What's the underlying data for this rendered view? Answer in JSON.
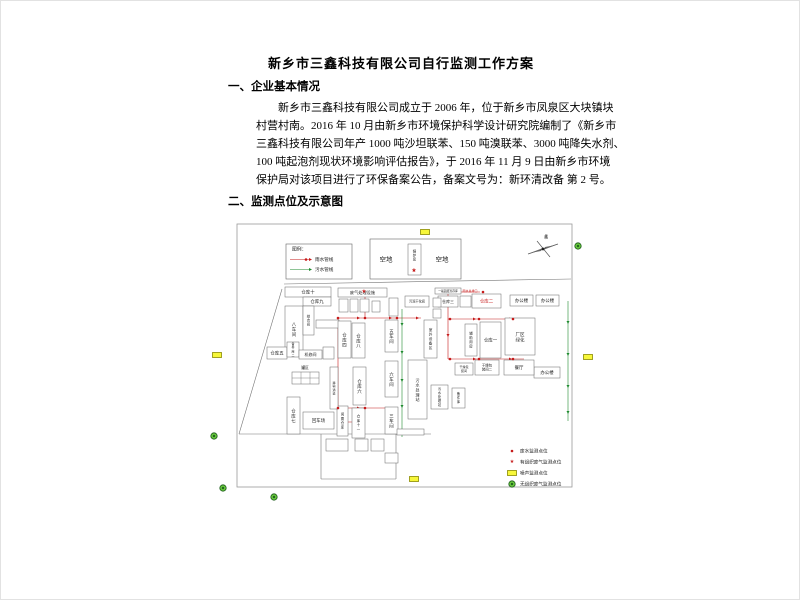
{
  "page": {
    "title": "新乡市三鑫科技有限公司自行监测工作方案",
    "section1": "一、企业基本情况",
    "paragraph_lines": [
      "新乡市三鑫科技有限公司成立于 2006 年，位于新乡市凤泉区大块镇块",
      "村营村南。2016 年 10 月由新乡市环境保护科学设计研究院编制了《新乡市",
      "三鑫科技有限公司年产 1000 吨沙坦联苯、150 吨溴联苯、3000 吨降失水剂、",
      "100 吨起泡剂现状环境影响评估报告》，于 2016 年 11 月 9 日由新乡市环境",
      "保护局对该项目进行了环保备案公告，备案文号为：新环清改备 第 2 号。"
    ],
    "section2": "二、监测点位及示意图"
  },
  "colors": {
    "red": "#c61a1a",
    "green": "#1f8a2f",
    "noise_fill": "#f7f73a",
    "noise_stroke": "#8a8a00",
    "gas_fill": "#63c23a",
    "gas_stroke": "#1d5c1d",
    "line_gray": "#777777",
    "box_stroke": "#666666",
    "label": "#222222"
  },
  "diagram": {
    "border": {
      "x": 236,
      "y": 223,
      "w": 335,
      "h": 263
    },
    "pipe_legend": {
      "x": 285,
      "y": 243,
      "w": 66,
      "h": 35,
      "title": "图例：",
      "items": [
        {
          "label": "雨水管线",
          "color_key": "red"
        },
        {
          "label": "污水管线",
          "color_key": "green"
        }
      ]
    },
    "empty_lot": {
      "box": {
        "x": 369,
        "y": 238,
        "w": 91,
        "h": 40
      },
      "labels": [
        {
          "t": "空地",
          "x": 385,
          "y": 259
        },
        {
          "t": "空地",
          "x": 441,
          "y": 259
        }
      ],
      "boiler": {
        "label": "锅炉房",
        "x": 407,
        "y": 243,
        "w": 13,
        "h": 31
      },
      "star": {
        "x": 413,
        "y": 270
      }
    },
    "compass": {
      "cx": 542,
      "cy": 248,
      "label": "北"
    },
    "boundary_lines": [
      [
        281,
        288,
        238,
        433
      ],
      [
        238,
        433,
        320,
        433
      ],
      [
        320,
        433,
        320,
        478
      ],
      [
        320,
        478,
        395,
        478
      ],
      [
        395,
        478,
        395,
        433
      ],
      [
        320,
        433,
        430,
        433
      ],
      [
        283,
        283,
        570,
        278
      ]
    ],
    "buildings": [
      {
        "l": "仓库十",
        "x": 284,
        "y": 286,
        "w": 46,
        "h": 10
      },
      {
        "l": "仓库九",
        "x": 302,
        "y": 296,
        "w": 28,
        "h": 9
      },
      {
        "l": "八车间",
        "x": 284,
        "y": 305,
        "w": 18,
        "h": 46,
        "v": 1
      },
      {
        "l": "综合间",
        "x": 302,
        "y": 305,
        "w": 11,
        "h": 29,
        "v": 1,
        "fs": 3.4
      },
      {
        "l": "",
        "x": 315,
        "y": 319,
        "w": 23,
        "h": 8
      },
      {
        "l": "仓库五",
        "x": 266,
        "y": 346,
        "w": 20,
        "h": 12
      },
      {
        "l": "备件库二",
        "x": 286,
        "y": 341,
        "w": 12,
        "h": 15,
        "v": 1,
        "fs": 3
      },
      {
        "l": "机修间",
        "x": 298,
        "y": 349,
        "w": 23,
        "h": 9,
        "fs": 4
      },
      {
        "l": "",
        "x": 322,
        "y": 346,
        "w": 11,
        "h": 12
      },
      {
        "l": "仓库七",
        "x": 286,
        "y": 396,
        "w": 13,
        "h": 37,
        "v": 1
      },
      {
        "l": "回车场",
        "x": 302,
        "y": 411,
        "w": 31,
        "h": 17
      },
      {
        "l": "闲置仓库",
        "x": 336,
        "y": 405,
        "w": 11,
        "h": 30,
        "v": 1,
        "fs": 3.4
      },
      {
        "l": "仓库十一",
        "x": 351,
        "y": 407,
        "w": 13,
        "h": 30,
        "v": 1,
        "fs": 3.4
      },
      {
        "l": "运输通道",
        "x": 329,
        "y": 366,
        "w": 8,
        "h": 42,
        "v": 1,
        "fs": 3
      },
      {
        "l": "仓库六",
        "x": 352,
        "y": 366,
        "w": 13,
        "h": 38,
        "v": 1
      },
      {
        "l": "仓库四",
        "x": 337,
        "y": 320,
        "w": 13,
        "h": 37,
        "v": 1
      },
      {
        "l": "仓库八",
        "x": 351,
        "y": 322,
        "w": 13,
        "h": 35,
        "v": 1
      },
      {
        "l": "五车间",
        "x": 384,
        "y": 319,
        "w": 13,
        "h": 32,
        "v": 1
      },
      {
        "l": "六车间",
        "x": 384,
        "y": 360,
        "w": 13,
        "h": 36,
        "v": 1
      },
      {
        "l": "三车间",
        "x": 384,
        "y": 406,
        "w": 13,
        "h": 27,
        "v": 1
      },
      {
        "l": "污水处理站",
        "x": 407,
        "y": 359,
        "w": 19,
        "h": 59,
        "v": 1,
        "fs": 4
      },
      {
        "l": "污水处理站",
        "x": 430,
        "y": 384,
        "w": 17,
        "h": 24,
        "v": 1,
        "fs": 3.2
      },
      {
        "l": "备件库",
        "x": 451,
        "y": 387,
        "w": 13,
        "h": 20,
        "v": 1,
        "fs": 3.2
      },
      {
        "l": "室外设备区",
        "x": 423,
        "y": 319,
        "w": 13,
        "h": 38,
        "v": 1,
        "fs": 3.6
      },
      {
        "l": "辅助用房",
        "x": 464,
        "y": 323,
        "w": 12,
        "h": 32,
        "v": 1,
        "fs": 3.4
      },
      {
        "l": "仓库一",
        "x": 479,
        "y": 321,
        "w": 21,
        "h": 36
      },
      {
        "l": "厂区绿化",
        "x": 504,
        "y": 317,
        "w": 30,
        "h": 37,
        "two": 1,
        "fs": 4.5
      },
      {
        "l": "仓库三",
        "x": 437,
        "y": 295,
        "w": 20,
        "h": 11,
        "fs": 4
      },
      {
        "l": "",
        "x": 459,
        "y": 295,
        "w": 11,
        "h": 11
      },
      {
        "l": "仓库二",
        "x": 471,
        "y": 293,
        "w": 29,
        "h": 14,
        "red": 1
      },
      {
        "l": "办公楼",
        "x": 509,
        "y": 294,
        "w": 23,
        "h": 11
      },
      {
        "l": "办公楼",
        "x": 535,
        "y": 294,
        "w": 23,
        "h": 11
      },
      {
        "l": "办公楼",
        "x": 533,
        "y": 366,
        "w": 26,
        "h": 11
      },
      {
        "l": "餐厅",
        "x": 503,
        "y": 359,
        "w": 30,
        "h": 15
      },
      {
        "l": "干燥包装间二",
        "x": 474,
        "y": 359,
        "w": 24,
        "h": 15,
        "two": 1,
        "fs": 3.4
      },
      {
        "l": "干燥包装间",
        "x": 454,
        "y": 362,
        "w": 18,
        "h": 12,
        "two": 1,
        "fs": 3
      },
      {
        "l": "废气处理设施",
        "x": 337,
        "y": 287,
        "w": 49,
        "h": 9,
        "fs": 4.2
      },
      {
        "l": "",
        "x": 338,
        "y": 298,
        "w": 9,
        "h": 13
      },
      {
        "l": "",
        "x": 349,
        "y": 298,
        "w": 8,
        "h": 13
      },
      {
        "l": "",
        "x": 359,
        "y": 298,
        "w": 9,
        "h": 13
      },
      {
        "l": "",
        "x": 371,
        "y": 300,
        "w": 8,
        "h": 11
      },
      {
        "l": "",
        "x": 388,
        "y": 297,
        "w": 9,
        "h": 18
      },
      {
        "l": "污泥干化间",
        "x": 404,
        "y": 295,
        "w": 24,
        "h": 11,
        "fs": 3.2
      },
      {
        "l": "",
        "x": 432,
        "y": 297,
        "w": 8,
        "h": 9
      },
      {
        "l": "",
        "x": 432,
        "y": 308,
        "w": 8,
        "h": 9
      },
      {
        "l": "一般固废暂存库",
        "x": 434,
        "y": 287,
        "w": 26,
        "h": 6,
        "fs": 2.8
      },
      {
        "l": "",
        "x": 325,
        "y": 438,
        "w": 22,
        "h": 12
      },
      {
        "l": "",
        "x": 354,
        "y": 438,
        "w": 13,
        "h": 12
      },
      {
        "l": "",
        "x": 370,
        "y": 438,
        "w": 13,
        "h": 12
      },
      {
        "l": "",
        "x": 384,
        "y": 452,
        "w": 13,
        "h": 10
      },
      {
        "l": "",
        "x": 396,
        "y": 428,
        "w": 27,
        "h": 6
      }
    ],
    "tank": {
      "x": 291,
      "y": 371,
      "w": 27,
      "h": 12,
      "cols": 3,
      "rows": 2,
      "label": "罐区",
      "lx": 304,
      "ly": 367
    },
    "free_labels": [
      {
        "t": "雨水总排口",
        "x": 469,
        "y": 290,
        "fs": 3,
        "red": 1
      },
      {
        "t": "北",
        "x": 545,
        "y": 236,
        "fs": 4
      }
    ],
    "pipelines": [
      {
        "x1": 337,
        "y1": 317,
        "x2": 420,
        "y2": 317,
        "c": "red"
      },
      {
        "x1": 364,
        "y1": 296,
        "x2": 364,
        "y2": 317,
        "c": "red"
      },
      {
        "x1": 447,
        "y1": 291,
        "x2": 479,
        "y2": 291,
        "c": "red"
      },
      {
        "x1": 447,
        "y1": 291,
        "x2": 447,
        "y2": 358,
        "c": "red"
      },
      {
        "x1": 447,
        "y1": 318,
        "x2": 523,
        "y2": 318,
        "c": "red"
      },
      {
        "x1": 447,
        "y1": 358,
        "x2": 523,
        "y2": 358,
        "c": "red"
      },
      {
        "x1": 337,
        "y1": 317,
        "x2": 337,
        "y2": 421,
        "c": "red"
      },
      {
        "x1": 337,
        "y1": 407,
        "x2": 395,
        "y2": 407,
        "c": "red"
      },
      {
        "x1": 337,
        "y1": 421,
        "x2": 364,
        "y2": 421,
        "c": "red"
      },
      {
        "x1": 401,
        "y1": 308,
        "x2": 401,
        "y2": 436,
        "c": "green"
      },
      {
        "x1": 567,
        "y1": 300,
        "x2": 567,
        "y2": 420,
        "c": "green"
      }
    ],
    "arrows": [
      {
        "x": 356,
        "y": 317,
        "d": "r",
        "c": "red"
      },
      {
        "x": 388,
        "y": 317,
        "d": "r",
        "c": "red"
      },
      {
        "x": 415,
        "y": 317,
        "d": "r",
        "c": "red"
      },
      {
        "x": 472,
        "y": 318,
        "d": "r",
        "c": "red"
      },
      {
        "x": 508,
        "y": 318,
        "d": "r",
        "c": "red"
      },
      {
        "x": 472,
        "y": 358,
        "d": "r",
        "c": "red"
      },
      {
        "x": 508,
        "y": 358,
        "d": "r",
        "c": "red"
      },
      {
        "x": 356,
        "y": 407,
        "d": "r",
        "c": "red"
      },
      {
        "x": 364,
        "y": 306,
        "d": "d",
        "c": "red"
      },
      {
        "x": 447,
        "y": 333,
        "d": "d",
        "c": "red"
      },
      {
        "x": 401,
        "y": 322,
        "d": "d",
        "c": "green"
      },
      {
        "x": 401,
        "y": 350,
        "d": "d",
        "c": "green"
      },
      {
        "x": 401,
        "y": 378,
        "d": "d",
        "c": "green"
      },
      {
        "x": 401,
        "y": 404,
        "d": "d",
        "c": "green"
      },
      {
        "x": 401,
        "y": 428,
        "d": "d",
        "c": "green"
      },
      {
        "x": 567,
        "y": 320,
        "d": "d",
        "c": "green"
      },
      {
        "x": 567,
        "y": 352,
        "d": "d",
        "c": "green"
      },
      {
        "x": 567,
        "y": 384,
        "d": "d",
        "c": "green"
      },
      {
        "x": 567,
        "y": 410,
        "d": "d",
        "c": "green"
      }
    ],
    "dots": [
      [
        482,
        291
      ],
      [
        337,
        317
      ],
      [
        364,
        317
      ],
      [
        396,
        317
      ],
      [
        449,
        318
      ],
      [
        478,
        318
      ],
      [
        512,
        318
      ],
      [
        449,
        358
      ],
      [
        478,
        358
      ],
      [
        512,
        358
      ],
      [
        337,
        407
      ],
      [
        364,
        407
      ]
    ],
    "stars": [
      [
        413,
        270
      ],
      [
        363,
        291
      ]
    ],
    "noise_rects": [
      [
        424,
        231
      ],
      [
        216,
        354
      ],
      [
        587,
        356
      ],
      [
        413,
        478
      ]
    ],
    "gas_circles": [
      [
        577,
        245
      ],
      [
        213,
        435
      ],
      [
        222,
        487
      ],
      [
        273,
        496
      ]
    ],
    "point_legend": {
      "x": 511,
      "y": 450,
      "row_h": 11,
      "items": [
        {
          "type": "dot",
          "label": "废水监测点位"
        },
        {
          "type": "star",
          "label": "有组织废气监测点位"
        },
        {
          "type": "noise",
          "label": "噪声监测点位"
        },
        {
          "type": "gas",
          "label": "无组织废气监测点位"
        }
      ]
    }
  }
}
